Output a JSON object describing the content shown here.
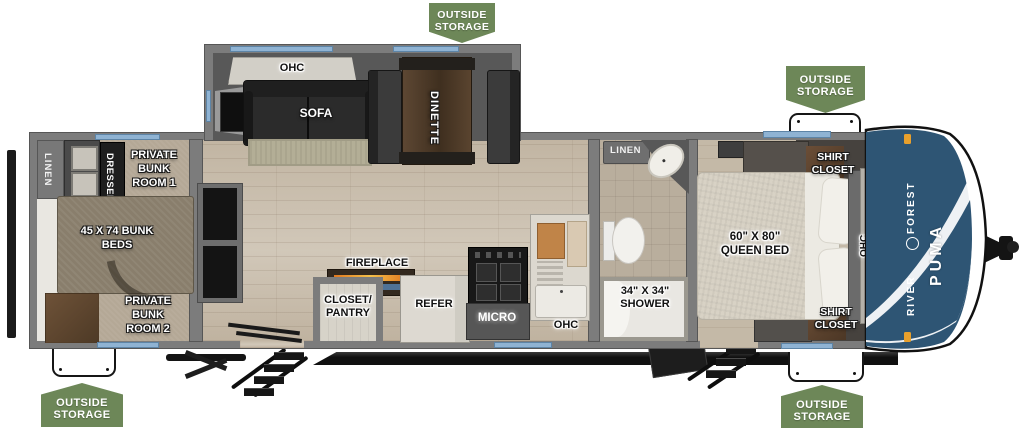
{
  "plan_title": "Forest River Puma travel trailer floorplan",
  "badge": {
    "line1": "OUTSIDE",
    "line2": "STORAGE"
  },
  "labels": {
    "linen_rear": "LINEN",
    "dresser": "DRESSER",
    "bunk_room_1": "PRIVATE BUNK ROOM 1",
    "bunk_beds": "45 X 74 BUNK BEDS",
    "bunk_room_2": "PRIVATE BUNK ROOM 2",
    "ohc_slide": "OHC",
    "sofa": "SOFA",
    "dinette": "DINETTE",
    "fireplace": "FIREPLACE",
    "closet_pantry": {
      "line1": "CLOSET/",
      "line2": "PANTRY"
    },
    "refer": "REFER",
    "micro": "MICRO",
    "ohc_kitchen": "OHC",
    "linen_bath": "LINEN",
    "shower": {
      "line1": "34\" X 34\"",
      "line2": "SHOWER"
    },
    "queen_bed": {
      "line1": "60\" X 80\"",
      "line2": "QUEEN BED"
    },
    "shirt_closet_top": "SHIRT CLOSET",
    "shirt_closet_bottom": "SHIRT CLOSET",
    "ohc_bedroom": "OHC"
  },
  "cap": {
    "brand": "FOREST RIVER",
    "model": "PUMA"
  },
  "colors": {
    "badge_green": "#6d8758",
    "cap_blue": "#2e5574",
    "window_blue": "#8fb3d3",
    "wall_gray": "#7c7c7c",
    "floor_tan": "#cbc0af",
    "flame_orange": "#e07820"
  }
}
